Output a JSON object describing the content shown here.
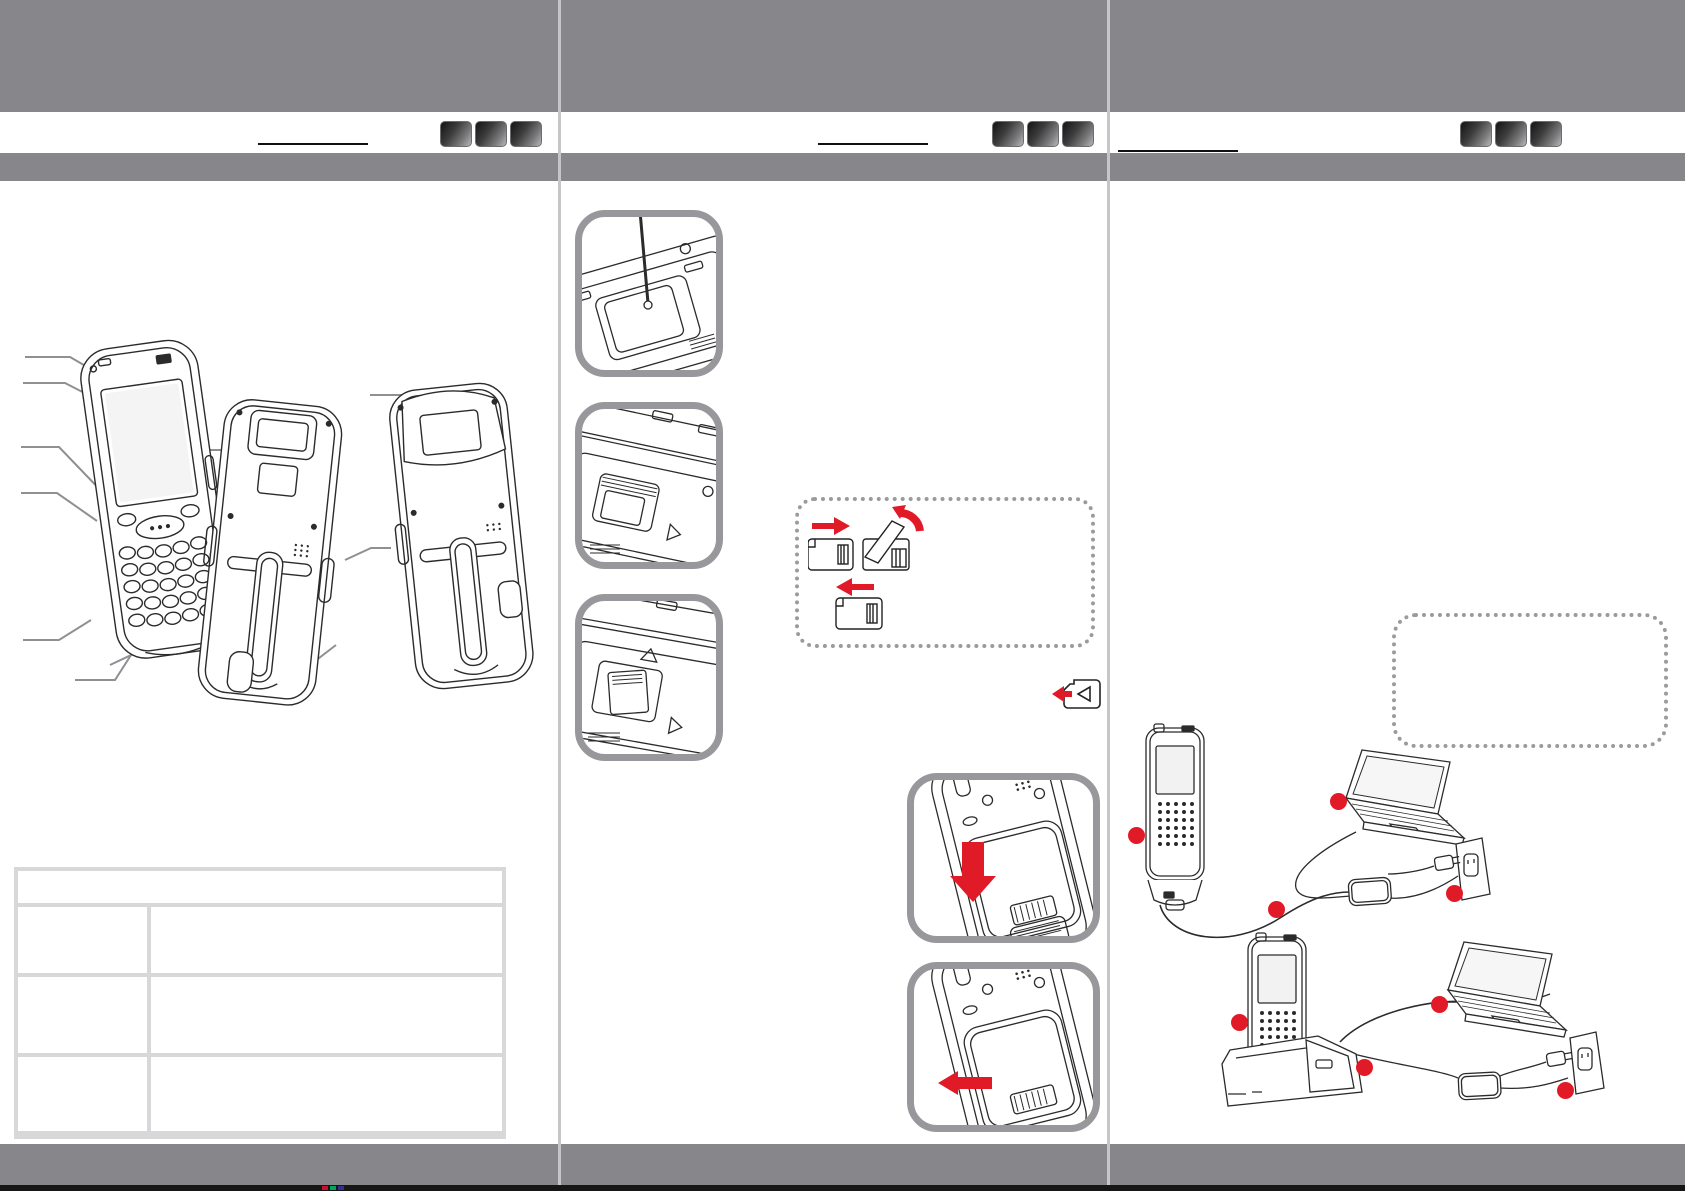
{
  "document": {
    "kind": "scanned-quick-start-guide-spread",
    "panels_count": 3,
    "visible_text": ""
  },
  "colors": {
    "band_gray": "#87878b",
    "accent_red": "#e11a27",
    "frame_gray": "#98989c",
    "dotted_gray": "#9b9b9f",
    "table_border": "#d8d8da",
    "divider": "#c6c6c8",
    "line_art": "#2b2b2b",
    "leader_line": "#909094"
  },
  "panels": [
    {
      "name": "left-panel",
      "header": {
        "underline_present": true,
        "nav_squares": [
          "",
          "",
          ""
        ]
      },
      "figures": [
        {
          "name": "terminal-front-view"
        },
        {
          "name": "terminal-back-view-strap"
        },
        {
          "name": "terminal-back-view-grip"
        }
      ],
      "table": {
        "header": "",
        "rows": [
          [
            "",
            ""
          ],
          [
            "",
            ""
          ],
          [
            "",
            ""
          ]
        ]
      }
    },
    {
      "name": "middle-panel",
      "header": {
        "underline_present": true,
        "nav_squares": [
          "",
          "",
          ""
        ]
      },
      "steps": [
        {
          "name": "open-compartment-with-stylus"
        },
        {
          "name": "memory-card-slot-open"
        },
        {
          "name": "memory-card-inserted"
        },
        {
          "name": "card-flip-orientation-inset"
        },
        {
          "name": "card-eject-icon"
        },
        {
          "name": "insert-battery-press-down"
        },
        {
          "name": "slide-battery-latch-left"
        }
      ]
    },
    {
      "name": "right-panel",
      "header": {
        "underline_present": true,
        "nav_squares": [
          "",
          "",
          ""
        ]
      },
      "note_box": {
        "text": ""
      },
      "scenes": [
        {
          "name": "charging-direct-cable",
          "components": [
            "handheld-terminal",
            "laptop",
            "power-adapter",
            "wall-outlet"
          ],
          "markers": 4
        },
        {
          "name": "charging-via-cradle",
          "components": [
            "handheld-terminal-in-cradle",
            "laptop",
            "power-adapter",
            "wall-outlet"
          ],
          "markers": 4
        }
      ],
      "markers_total": 8
    }
  ],
  "print_registration_marks": [
    "#c8102e",
    "#00a651",
    "#2e3192"
  ]
}
